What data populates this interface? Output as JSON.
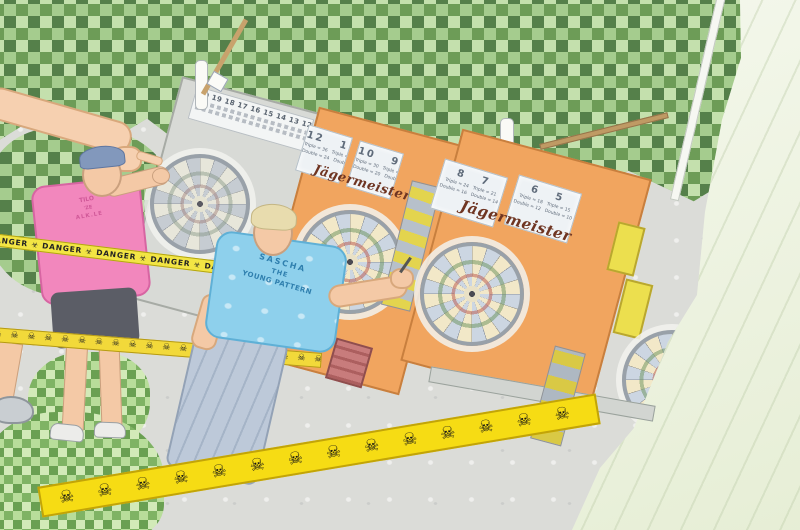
{
  "scene_title": "Outdoor darts tournament (posterized photo)",
  "people": {
    "pink_player": {
      "shirt_line1": "TILO",
      "shirt_line2": "'ZE",
      "shirt_line3": "ALK.LE"
    },
    "blue_player": {
      "shirt_line1": "SASCHA",
      "shirt_line2": "THE",
      "shirt_line3": "YOUNG PATTERN"
    }
  },
  "panels": {
    "brand_label": "Jägermeister",
    "left_score_strip": "20 19 18 17 16 15 14 13 12 11",
    "middle_cards": [
      {
        "numbers": "12   11",
        "line1": "Triple = 36   Triple = 33",
        "line2": "Double = 24   Double = 22"
      },
      {
        "numbers": "10   9",
        "line1": "Triple = 30   Triple = 27",
        "line2": "Double = 20   Double = 18"
      }
    ],
    "right_cards": [
      {
        "numbers": "8   7",
        "line1": "Triple = 24   Triple = 21",
        "line2": "Double = 16   Double = 14"
      },
      {
        "numbers": "6   5",
        "line1": "Triple = 18   Triple = 15",
        "line2": "Double = 12   Double = 10"
      }
    ]
  },
  "tapes": {
    "danger": "DANGER ☣ DANGER ☣ DANGER ☣ DANGER ☣ DANGER ☣ DANGER ☣ DANGER",
    "skulls_small": "☠ ☠ ☠ ☠ ☠ ☠ ☠ ☠ ☠ ☠ ☠ ☠ ☠ ☠ ☠ ☠ ☠ ☠ ☠ ☠ ☠ ☠ ☠ ☠ ☠ ☠",
    "skulls_large": "☠ ☠ ☠ ☠ ☠ ☠ ☠ ☠ ☠ ☠ ☠ ☠ ☠ ☠"
  },
  "colors": {
    "panel_orange": "#f1a55f",
    "tape_yellow": "#f6dc14",
    "shirt_pink": "#f287bd",
    "shirt_blue": "#8ed0ec",
    "foliage_green": "#8db477"
  }
}
